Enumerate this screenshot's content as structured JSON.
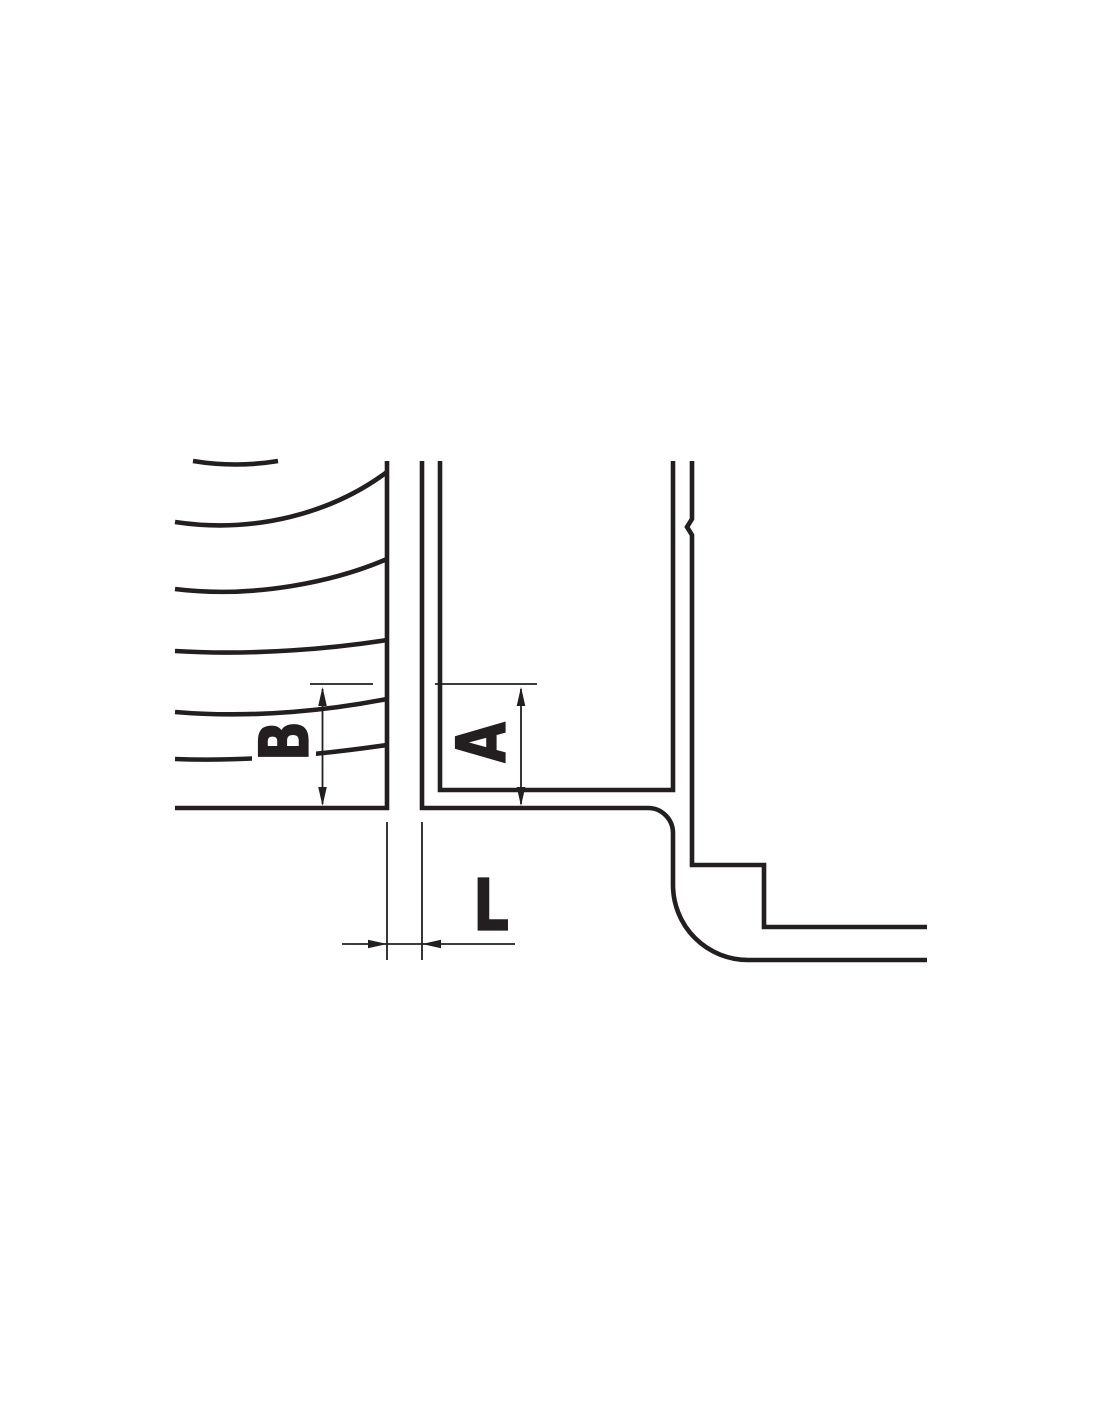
{
  "page": {
    "background": "#ffffff"
  },
  "diagram": {
    "kind": "engineering-cross-section",
    "line_color": "#231f20",
    "labels": {
      "b": "B",
      "a": "A",
      "l": "L"
    }
  }
}
